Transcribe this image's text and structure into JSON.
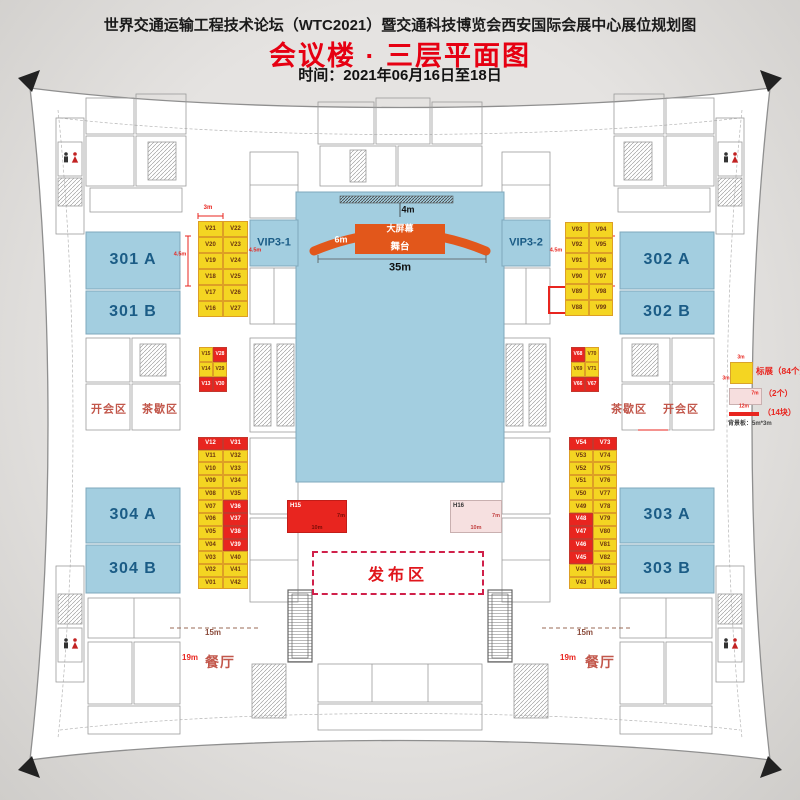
{
  "header": {
    "title": "世界交通运输工程技术论坛（WTC2021）暨交通科技博览会西安国际会展中心展位规划图",
    "subtitle": "会议楼 · 三层平面图",
    "time": "时间：2021年06月16日至18日"
  },
  "rooms": {
    "r301a": "301 A",
    "r301b": "301 B",
    "r302a": "302 A",
    "r302b": "302 B",
    "r303a": "303 A",
    "r303b": "303 B",
    "r304a": "304 A",
    "r304b": "304 B",
    "vip31": "VIP3-1",
    "vip32": "VIP3-2"
  },
  "stage": {
    "screen": "大屏幕",
    "platform": "舞台"
  },
  "zones": {
    "meeting": "开会区",
    "tea": "茶歇区",
    "release": "发布区",
    "restaurant": "餐厅"
  },
  "special_booths": {
    "h15": "H15",
    "h16": "H16"
  },
  "dims": {
    "m3": "3m",
    "m4": "4m",
    "m45": "4.5m",
    "m6": "6m",
    "m7": "7m",
    "m10": "10m",
    "m12": "12m",
    "m15": "15m",
    "m19": "19m",
    "m35": "35m"
  },
  "legend": {
    "standard": {
      "label": "标展（84个）",
      "size": "3m"
    },
    "special": {
      "label": "（2个）",
      "w": "12m",
      "h": "7m"
    },
    "board": {
      "label": "（14块）",
      "note": "背景板：5m*3m"
    }
  },
  "booth_grids": {
    "top_left": {
      "rows": [
        [
          "V21",
          "V22"
        ],
        [
          "V20",
          "V23"
        ],
        [
          "V19",
          "V24"
        ],
        [
          "V18",
          "V25"
        ],
        [
          "V17",
          "V26"
        ],
        [
          "V16",
          "V27"
        ]
      ],
      "red": []
    },
    "top_right": {
      "rows": [
        [
          "V93",
          "V94"
        ],
        [
          "V92",
          "V95"
        ],
        [
          "V91",
          "V96"
        ],
        [
          "V90",
          "V97"
        ],
        [
          "V89",
          "V98"
        ],
        [
          "V88",
          "V99"
        ]
      ],
      "red": []
    },
    "mid_left": {
      "rows": [
        [
          "V15",
          "V28"
        ],
        [
          "V14",
          "V29"
        ],
        [
          "V13",
          "V30"
        ]
      ],
      "red": [
        [
          0,
          1
        ],
        [
          2,
          0
        ],
        [
          2,
          1
        ]
      ]
    },
    "mid_right": {
      "rows": [
        [
          "V68",
          "V70"
        ],
        [
          "V69",
          "V71"
        ],
        [
          "V66",
          "V67"
        ]
      ],
      "red": [
        [
          0,
          0
        ],
        [
          2,
          0
        ],
        [
          2,
          1
        ]
      ]
    },
    "bottom_left": {
      "rows": [
        [
          "V12",
          "V31"
        ],
        [
          "V11",
          "V32"
        ],
        [
          "V10",
          "V33"
        ],
        [
          "V09",
          "V34"
        ],
        [
          "V08",
          "V35"
        ],
        [
          "V07",
          "V36"
        ],
        [
          "V06",
          "V37"
        ],
        [
          "V05",
          "V38"
        ],
        [
          "V04",
          "V39"
        ],
        [
          "V03",
          "V40"
        ],
        [
          "V02",
          "V41"
        ],
        [
          "V01",
          "V42"
        ]
      ],
      "red": [
        [
          0,
          0
        ],
        [
          0,
          1
        ],
        [
          5,
          1
        ],
        [
          6,
          1
        ],
        [
          7,
          1
        ],
        [
          8,
          1
        ]
      ]
    },
    "bottom_right": {
      "rows": [
        [
          "V54",
          "V73"
        ],
        [
          "V53",
          "V74"
        ],
        [
          "V52",
          "V75"
        ],
        [
          "V51",
          "V76"
        ],
        [
          "V50",
          "V77"
        ],
        [
          "V49",
          "V78"
        ],
        [
          "V48",
          "V79"
        ],
        [
          "V47",
          "V80"
        ],
        [
          "V46",
          "V81"
        ],
        [
          "V45",
          "V82"
        ],
        [
          "V44",
          "V83"
        ],
        [
          "V43",
          "V84"
        ]
      ],
      "red": [
        [
          0,
          0
        ],
        [
          0,
          1
        ],
        [
          6,
          0
        ],
        [
          7,
          0
        ],
        [
          8,
          0
        ],
        [
          9,
          0
        ]
      ]
    }
  }
}
